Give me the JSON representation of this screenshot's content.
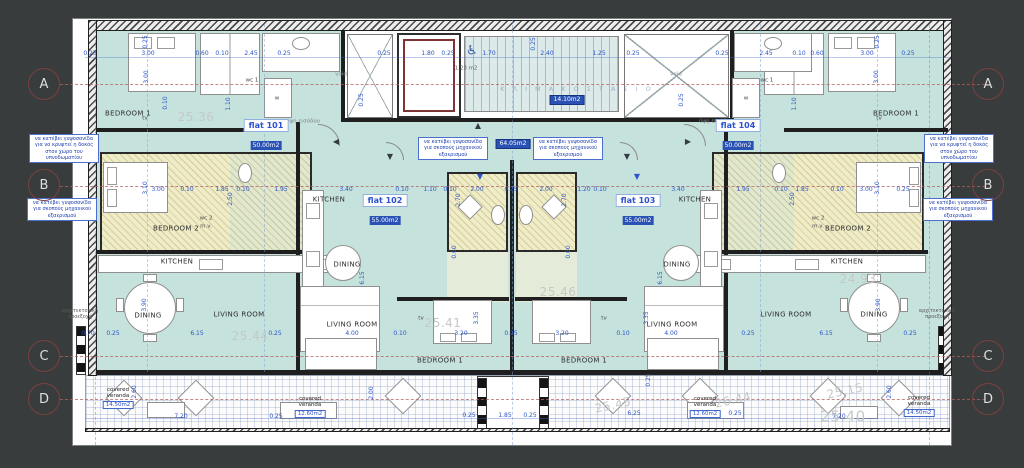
{
  "colors": {
    "bg": "#393c3c",
    "teal": "#c6e2dd",
    "badge": "#2a52b4",
    "flat": "#2b50d0"
  },
  "grid_bubbles": {
    "letters": [
      "A",
      "B",
      "C",
      "D"
    ],
    "left_x": 44,
    "right_x": 988,
    "ys": [
      84,
      185,
      356,
      399
    ]
  },
  "flats": [
    {
      "name": "flat 101",
      "area": "50.00m2",
      "x": 266,
      "y": 135
    },
    {
      "name": "flat 102",
      "area": "55.00m2",
      "x": 385,
      "y": 210
    },
    {
      "name": "flat 103",
      "area": "55.00m2",
      "x": 638,
      "y": 210
    },
    {
      "name": "flat 104",
      "area": "50.00m2",
      "x": 738,
      "y": 135
    }
  ],
  "room_labels": [
    {
      "t": "BEDROOM 1",
      "x": 128,
      "y": 114
    },
    {
      "t": "BEDROOM 1",
      "x": 896,
      "y": 114
    },
    {
      "t": "BEDROOM 1",
      "x": 440,
      "y": 361
    },
    {
      "t": "BEDROOM 1",
      "x": 584,
      "y": 361
    },
    {
      "t": "BEDROOM 2",
      "x": 176,
      "y": 229
    },
    {
      "t": "BEDROOM 2",
      "x": 848,
      "y": 229
    },
    {
      "t": "KITCHEN",
      "x": 177,
      "y": 262
    },
    {
      "t": "KITCHEN",
      "x": 329,
      "y": 200
    },
    {
      "t": "KITCHEN",
      "x": 695,
      "y": 200
    },
    {
      "t": "KITCHEN",
      "x": 847,
      "y": 262
    },
    {
      "t": "DINING",
      "x": 148,
      "y": 316
    },
    {
      "t": "DINING",
      "x": 347,
      "y": 265
    },
    {
      "t": "DINING",
      "x": 677,
      "y": 265
    },
    {
      "t": "DINING",
      "x": 874,
      "y": 315
    },
    {
      "t": "LIVING ROOM",
      "x": 239,
      "y": 315
    },
    {
      "t": "LIVING ROOM",
      "x": 352,
      "y": 325
    },
    {
      "t": "LIVING ROOM",
      "x": 672,
      "y": 325
    },
    {
      "t": "LIVING ROOM",
      "x": 786,
      "y": 315
    }
  ],
  "small_labels": [
    {
      "t": "wc 1",
      "x": 252,
      "y": 81
    },
    {
      "t": "wc 1",
      "x": 767,
      "y": 81
    },
    {
      "t": "wc 2",
      "x": 206,
      "y": 219
    },
    {
      "t": "m.v.",
      "x": 206,
      "y": 227
    },
    {
      "t": "wc 2",
      "x": 818,
      "y": 219
    },
    {
      "t": "m.v.",
      "x": 818,
      "y": 227
    },
    {
      "t": "void",
      "x": 341,
      "y": 75,
      "c": "#8a9094"
    },
    {
      "t": "void",
      "x": 676,
      "y": 75,
      "c": "#8a9094"
    },
    {
      "t": "tv",
      "x": 145,
      "y": 119
    },
    {
      "t": "tv",
      "x": 879,
      "y": 119
    },
    {
      "t": "tv",
      "x": 421,
      "y": 319
    },
    {
      "t": "tv",
      "x": 604,
      "y": 319
    },
    {
      "t": "w",
      "x": 277,
      "y": 99
    },
    {
      "t": "w",
      "x": 746,
      "y": 99
    },
    {
      "t": "1.23 m2",
      "x": 466,
      "y": 69,
      "c": "#5d6166"
    },
    {
      "t": "2.92",
      "x": 47,
      "y": 159,
      "c": "#98a0a8"
    },
    {
      "t": "όψη εισόδου",
      "x": 303,
      "y": 122,
      "c": "#7d838a"
    },
    {
      "t": "όψη εισόδου",
      "x": 716,
      "y": 122,
      "c": "#7d838a"
    }
  ],
  "dims_h": [
    {
      "t": "0.25",
      "x": 90,
      "y": 54
    },
    {
      "t": "3.00",
      "x": 148,
      "y": 54
    },
    {
      "t": "0.60",
      "x": 202,
      "y": 54
    },
    {
      "t": "0.10",
      "x": 222,
      "y": 54
    },
    {
      "t": "2.45",
      "x": 251,
      "y": 54
    },
    {
      "t": "0.25",
      "x": 284,
      "y": 54
    },
    {
      "t": "0.25",
      "x": 384,
      "y": 54
    },
    {
      "t": "1.80",
      "x": 428,
      "y": 54
    },
    {
      "t": "0.25",
      "x": 448,
      "y": 54
    },
    {
      "t": "1.70",
      "x": 489,
      "y": 54
    },
    {
      "t": "2.40",
      "x": 547,
      "y": 54
    },
    {
      "t": "1.25",
      "x": 599,
      "y": 54
    },
    {
      "t": "0.25",
      "x": 633,
      "y": 54
    },
    {
      "t": "0.25",
      "x": 722,
      "y": 54
    },
    {
      "t": "2.45",
      "x": 766,
      "y": 54
    },
    {
      "t": "0.10",
      "x": 799,
      "y": 54
    },
    {
      "t": "0.60",
      "x": 817,
      "y": 54
    },
    {
      "t": "3.00",
      "x": 867,
      "y": 54
    },
    {
      "t": "0.25",
      "x": 908,
      "y": 54
    },
    {
      "t": "3.00",
      "x": 158,
      "y": 190
    },
    {
      "t": "0.10",
      "x": 187,
      "y": 190
    },
    {
      "t": "1.85",
      "x": 222,
      "y": 190
    },
    {
      "t": "0.10",
      "x": 243,
      "y": 190
    },
    {
      "t": "1.95",
      "x": 281,
      "y": 190
    },
    {
      "t": "3.40",
      "x": 346,
      "y": 190
    },
    {
      "t": "0.10",
      "x": 402,
      "y": 190
    },
    {
      "t": "1.10",
      "x": 430,
      "y": 190
    },
    {
      "t": "0.10",
      "x": 450,
      "y": 190
    },
    {
      "t": "2.00",
      "x": 477,
      "y": 190
    },
    {
      "t": "0.25",
      "x": 511,
      "y": 190
    },
    {
      "t": "2.00",
      "x": 546,
      "y": 190
    },
    {
      "t": "1.20",
      "x": 584,
      "y": 190
    },
    {
      "t": "0.10",
      "x": 600,
      "y": 190
    },
    {
      "t": "3.40",
      "x": 678,
      "y": 190
    },
    {
      "t": "1.95",
      "x": 743,
      "y": 190
    },
    {
      "t": "0.10",
      "x": 781,
      "y": 190
    },
    {
      "t": "1.85",
      "x": 802,
      "y": 190
    },
    {
      "t": "0.10",
      "x": 837,
      "y": 190
    },
    {
      "t": "3.00",
      "x": 866,
      "y": 190
    },
    {
      "t": "0.25",
      "x": 903,
      "y": 190
    },
    {
      "t": "0.70",
      "x": 88,
      "y": 334
    },
    {
      "t": "0.25",
      "x": 113,
      "y": 334
    },
    {
      "t": "6.15",
      "x": 197,
      "y": 334
    },
    {
      "t": "0.25",
      "x": 275,
      "y": 334
    },
    {
      "t": "4.00",
      "x": 352,
      "y": 334
    },
    {
      "t": "0.10",
      "x": 400,
      "y": 334
    },
    {
      "t": "3.20",
      "x": 461,
      "y": 334
    },
    {
      "t": "0.25",
      "x": 511,
      "y": 334
    },
    {
      "t": "3.20",
      "x": 562,
      "y": 334
    },
    {
      "t": "0.10",
      "x": 623,
      "y": 334
    },
    {
      "t": "4.00",
      "x": 671,
      "y": 334
    },
    {
      "t": "0.25",
      "x": 748,
      "y": 334
    },
    {
      "t": "6.15",
      "x": 826,
      "y": 334
    },
    {
      "t": "0.25",
      "x": 910,
      "y": 334
    },
    {
      "t": "7.20",
      "x": 181,
      "y": 417
    },
    {
      "t": "0.25",
      "x": 276,
      "y": 417
    },
    {
      "t": "0.25",
      "x": 469,
      "y": 416
    },
    {
      "t": "1.85",
      "x": 505,
      "y": 416
    },
    {
      "t": "0.25",
      "x": 530,
      "y": 416
    },
    {
      "t": "6.25",
      "x": 634,
      "y": 414
    },
    {
      "t": "0.25",
      "x": 735,
      "y": 414
    },
    {
      "t": "7.20",
      "x": 839,
      "y": 417
    }
  ],
  "dims_v": [
    {
      "t": "0.25",
      "x": 146,
      "y": 42
    },
    {
      "t": "3.00",
      "x": 147,
      "y": 77
    },
    {
      "t": "0.10",
      "x": 166,
      "y": 103
    },
    {
      "t": "1.10",
      "x": 229,
      "y": 104
    },
    {
      "t": "0.25",
      "x": 362,
      "y": 100
    },
    {
      "t": "0.25",
      "x": 534,
      "y": 44
    },
    {
      "t": "0.25",
      "x": 682,
      "y": 100
    },
    {
      "t": "3.00",
      "x": 877,
      "y": 77
    },
    {
      "t": "0.25",
      "x": 878,
      "y": 42
    },
    {
      "t": "1.10",
      "x": 795,
      "y": 104
    },
    {
      "t": "3.10",
      "x": 146,
      "y": 188
    },
    {
      "t": "2.50",
      "x": 231,
      "y": 199
    },
    {
      "t": "3.10",
      "x": 878,
      "y": 188
    },
    {
      "t": "2.50",
      "x": 793,
      "y": 199
    },
    {
      "t": "2.70",
      "x": 459,
      "y": 200
    },
    {
      "t": "2.70",
      "x": 565,
      "y": 200
    },
    {
      "t": "0.60",
      "x": 455,
      "y": 252
    },
    {
      "t": "0.60",
      "x": 569,
      "y": 252
    },
    {
      "t": "6.15",
      "x": 363,
      "y": 278
    },
    {
      "t": "6.15",
      "x": 661,
      "y": 278
    },
    {
      "t": "3.90",
      "x": 145,
      "y": 305
    },
    {
      "t": "3.90",
      "x": 879,
      "y": 305
    },
    {
      "t": "3.35",
      "x": 477,
      "y": 318
    },
    {
      "t": "3.35",
      "x": 647,
      "y": 318
    },
    {
      "t": "2.60",
      "x": 135,
      "y": 392
    },
    {
      "t": "2.00",
      "x": 372,
      "y": 393
    },
    {
      "t": "2.60",
      "x": 890,
      "y": 392
    },
    {
      "t": "0.25",
      "x": 649,
      "y": 380
    }
  ],
  "underlay": [
    {
      "t": "25.36",
      "x": 196,
      "y": 117
    },
    {
      "t": "25.44",
      "x": 250,
      "y": 336
    },
    {
      "t": "25.41",
      "x": 443,
      "y": 323
    },
    {
      "t": "25.46",
      "x": 558,
      "y": 292
    },
    {
      "t": "24.93",
      "x": 858,
      "y": 279
    },
    {
      "t": "25.15",
      "x": 845,
      "y": 391,
      "tilt": true
    },
    {
      "t": "25.40",
      "x": 843,
      "y": 417,
      "fs": 15
    },
    {
      "t": "25.45",
      "x": 613,
      "y": 405,
      "tilt": true
    },
    {
      "t": "26.44",
      "x": 733,
      "y": 400,
      "tilt": true
    }
  ],
  "notes": [
    {
      "t": "να κατέβει γυψοσανίδα για να κρυφτεί η δοκός στον χώρο του υπνοδωματίου",
      "x": 64,
      "y": 134
    },
    {
      "t": "να κατέβει γυψοσανίδα για σκοπούς μηχανικού εξαερισμού",
      "x": 62,
      "y": 198
    },
    {
      "t": "να κατέβει γυψοσανίδα για να κρυφτεί η δοκός στον χώρο του υπνοδωματίου",
      "x": 959,
      "y": 134
    },
    {
      "t": "να κατέβει γυψοσανίδα για σκοπούς μηχανικού εξαερισμού",
      "x": 958,
      "y": 198
    },
    {
      "t": "να κατέβει γυψοσανίδα για σκοπούς μηχανικού εξαερισμού",
      "x": 453,
      "y": 137
    },
    {
      "t": "να κατέβει γυψοσανίδα για σκοπούς μηχανικού εξαερισμού",
      "x": 568,
      "y": 137
    }
  ],
  "arch_notes": [
    {
      "t": "αρχιτεκτονική προεξοχή",
      "x": 80,
      "y": 308
    },
    {
      "t": "αρχιτεκτονική προεξοχή",
      "x": 937,
      "y": 308
    }
  ],
  "veranda_tags": [
    {
      "l1": "covered",
      "l2": "veranda",
      "area": "14.50m2",
      "x": 118,
      "y": 398
    },
    {
      "l1": "covered",
      "l2": "veranda",
      "area": "12.60m2",
      "x": 310,
      "y": 407
    },
    {
      "l1": "covered",
      "l2": "veranda",
      "area": "12.60m2",
      "x": 705,
      "y": 407
    },
    {
      "l1": "covered",
      "l2": "veranda",
      "area": "14.50m2",
      "x": 919,
      "y": 406
    }
  ],
  "badges": [
    {
      "t": "14.10m2",
      "x": 567,
      "y": 100
    },
    {
      "t": "64.05m2",
      "x": 513,
      "y": 144
    }
  ],
  "arrows": [
    {
      "g": "▲",
      "x": 478,
      "y": 126,
      "c": "#333b44"
    },
    {
      "g": "▼",
      "x": 390,
      "y": 157,
      "c": "#333b44"
    },
    {
      "g": "▼",
      "x": 627,
      "y": 157,
      "c": "#333b44"
    },
    {
      "g": "◀",
      "x": 336,
      "y": 142,
      "c": "#333b44"
    },
    {
      "g": "▶",
      "x": 688,
      "y": 142,
      "c": "#333b44"
    },
    {
      "g": "▼",
      "x": 480,
      "y": 177,
      "c": "#2b55c8"
    },
    {
      "g": "▼",
      "x": 637,
      "y": 177,
      "c": "#2b55c8"
    }
  ],
  "stair_text": {
    "t": "Κ Λ Ι Μ Α Κ Ο Σ Τ Α Σ Ι Ο",
    "x": 577,
    "y": 89
  },
  "wheelchair": {
    "g": "♿",
    "x": 472,
    "y": 51
  }
}
